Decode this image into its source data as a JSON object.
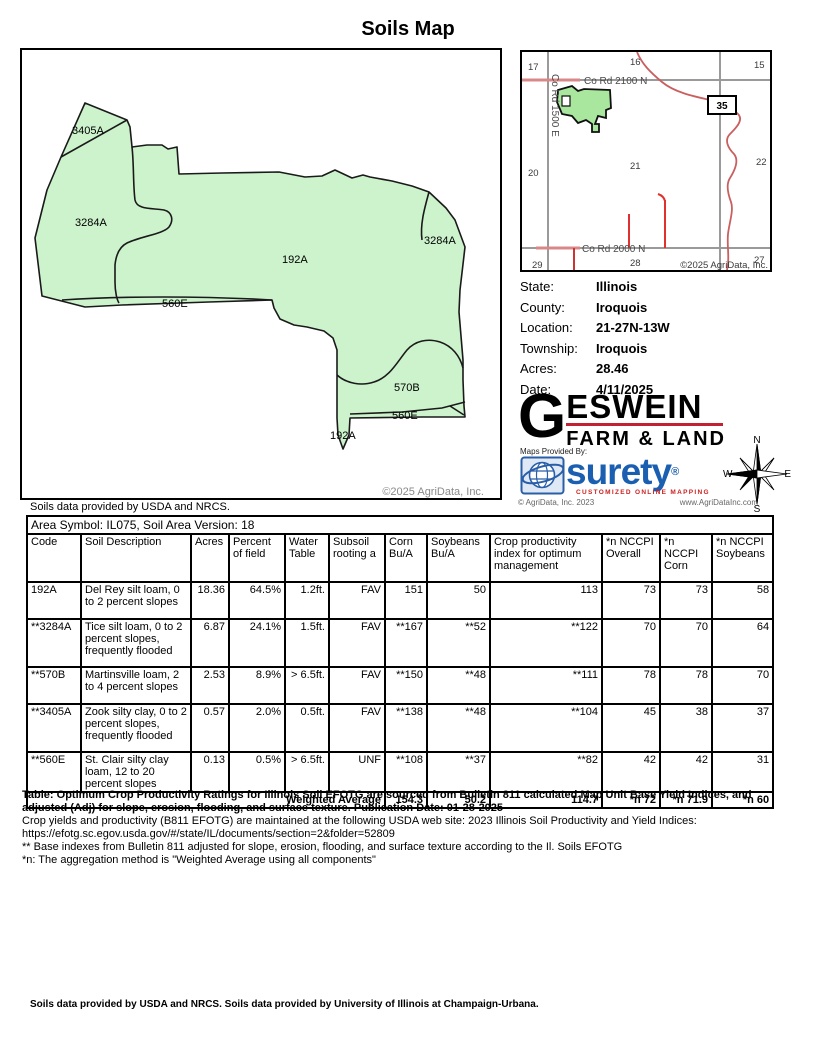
{
  "title": "Soils Map",
  "map": {
    "labels": [
      "3405A",
      "3284A",
      "192A",
      "3284A",
      "560E",
      "570B",
      "560E",
      "192A"
    ],
    "copyright": "©2025 AgriData, Inc.",
    "attribution": "Soils data provided by USDA and NRCS.",
    "fill_color": "#cdf3cd"
  },
  "inset": {
    "sections": [
      "17",
      "16",
      "15",
      "20",
      "21",
      "22",
      "29",
      "28",
      "27"
    ],
    "road_top": "Co Rd 2100 N",
    "road_left": "Co Rd 1500 E",
    "road_bottom": "Co Rd 2000 N",
    "highway_badge": "35",
    "copyright": "©2025 AgriData, Inc."
  },
  "info": [
    {
      "label": "State:",
      "value": "Illinois"
    },
    {
      "label": "County:",
      "value": "Iroquois"
    },
    {
      "label": "Location:",
      "value": "21-27N-13W"
    },
    {
      "label": "Township:",
      "value": "Iroquois"
    },
    {
      "label": "Acres:",
      "value": "28.46"
    },
    {
      "label": "Date:",
      "value": "4/11/2025"
    }
  ],
  "branding": {
    "geswein_g": "G",
    "geswein_rest": "ESWEIN",
    "geswein_sub": "FARM & LAND",
    "maps_provided": "Maps Provided By:",
    "surety": "surety",
    "surety_reg": "®",
    "surety_tagline": "CUSTOMIZED ONLINE MAPPING",
    "agridata_copyright": "© AgriData, Inc. 2023",
    "agridata_url": "www.AgriDataInc.com"
  },
  "compass": {
    "n": "N",
    "s": "S",
    "e": "E",
    "w": "W"
  },
  "table": {
    "area_line": "Area Symbol: IL075, Soil Area Version: 18",
    "headers": [
      "Code",
      "Soil Description",
      "Acres",
      "Percent of field",
      "Water Table",
      "Subsoil rooting a",
      "Corn Bu/A",
      "Soybeans Bu/A",
      "Crop productivity index for optimum management",
      "*n NCCPI Overall",
      "*n NCCPI Corn",
      "*n NCCPI Soybeans"
    ],
    "rows": [
      {
        "code": "192A",
        "desc": "Del Rey silt loam, 0 to 2 percent slopes",
        "acres": "18.36",
        "pct": "64.5%",
        "water": "1.2ft.",
        "subsoil": "FAV",
        "corn": "151",
        "soy": "50",
        "cpi": "113",
        "nccpi_overall": "73",
        "nccpi_corn": "73",
        "nccpi_soy": "58"
      },
      {
        "code": "**3284A",
        "desc": "Tice silt loam, 0 to 2 percent slopes, frequently flooded",
        "acres": "6.87",
        "pct": "24.1%",
        "water": "1.5ft.",
        "subsoil": "FAV",
        "corn": "**167",
        "soy": "**52",
        "cpi": "**122",
        "nccpi_overall": "70",
        "nccpi_corn": "70",
        "nccpi_soy": "64"
      },
      {
        "code": "**570B",
        "desc": "Martinsville loam, 2 to 4 percent slopes",
        "acres": "2.53",
        "pct": "8.9%",
        "water": "> 6.5ft.",
        "subsoil": "FAV",
        "corn": "**150",
        "soy": "**48",
        "cpi": "**111",
        "nccpi_overall": "78",
        "nccpi_corn": "78",
        "nccpi_soy": "70"
      },
      {
        "code": "**3405A",
        "desc": "Zook silty clay, 0 to 2 percent slopes, frequently flooded",
        "acres": "0.57",
        "pct": "2.0%",
        "water": "0.5ft.",
        "subsoil": "FAV",
        "corn": "**138",
        "soy": "**48",
        "cpi": "**104",
        "nccpi_overall": "45",
        "nccpi_corn": "38",
        "nccpi_soy": "37"
      },
      {
        "code": "**560E",
        "desc": "St. Clair silty clay loam, 12 to 20 percent slopes",
        "acres": "0.13",
        "pct": "0.5%",
        "water": "> 6.5ft.",
        "subsoil": "UNF",
        "corn": "**108",
        "soy": "**37",
        "cpi": "**82",
        "nccpi_overall": "42",
        "nccpi_corn": "42",
        "nccpi_soy": "31"
      }
    ],
    "weighted_avg": {
      "label": "Weighted Average",
      "corn": "154.3",
      "soy": "50.2",
      "cpi": "114.7",
      "nccpi_overall": "*n 72",
      "nccpi_corn": "*n 71.9",
      "nccpi_soy": "*n 60"
    }
  },
  "footnotes": [
    "Table: Optimum Crop Productivity Ratings for Illinois Soil EFOTG are sourced from Bulletin 811 calculated Map Unit Base Yield Indices, and adjusted (Adj) for slope, erosion, flooding, and surface texture. Publication Date: 01-28-2025",
    "Crop yields and productivity (B811 EFOTG) are maintained at the following USDA web site: 2023 Illinois Soil Productivity and Yield Indices:",
    "https://efotg.sc.egov.usda.gov/#/state/IL/documents/section=2&folder=52809",
    "** Base indexes from Bulletin 811 adjusted for slope, erosion, flooding, and surface texture according to the Il. Soils EFOTG",
    "*n: The aggregation method is \"Weighted Average using all components\""
  ],
  "footer": "Soils data provided by USDA and NRCS. Soils data provided by University of Illinois at Champaign-Urbana."
}
